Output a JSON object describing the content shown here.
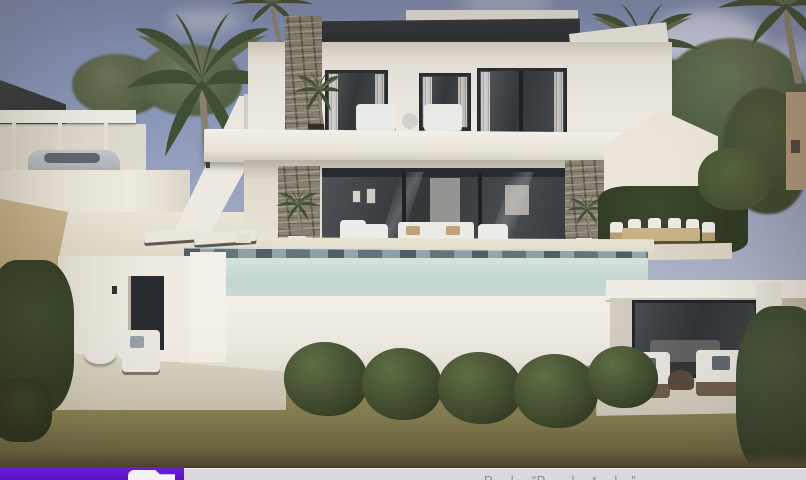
{
  "scene": {
    "subject": "3D architectural render of a modern two-storey white villa with stone accent columns, glass walls, balcony terrace, infinity pool, palm trees and landscaped garden",
    "palette": {
      "sky_top": "#7e8bb4",
      "sky_bottom": "#d2d1d1",
      "wall_light": "#f2eee5",
      "wall_shade": "#d9d3c7",
      "roof_dark": "#2a2d31",
      "glass_dark": "#34383b",
      "stone": "#877f70",
      "pool_glass": "#c9dcd5",
      "pool_waterline": "#8aa0a4",
      "deck": "#e8e1d1",
      "lawn": "#837b4e",
      "bush_green": "#3b4829"
    }
  },
  "bottom_bar": {
    "accent_color": "#5b11c9",
    "caption_background": "#dbd9dd",
    "icon": "file-icon",
    "caption": {
      "visible_text": "P… l…  “P….. l…  t… l…”"
    }
  }
}
